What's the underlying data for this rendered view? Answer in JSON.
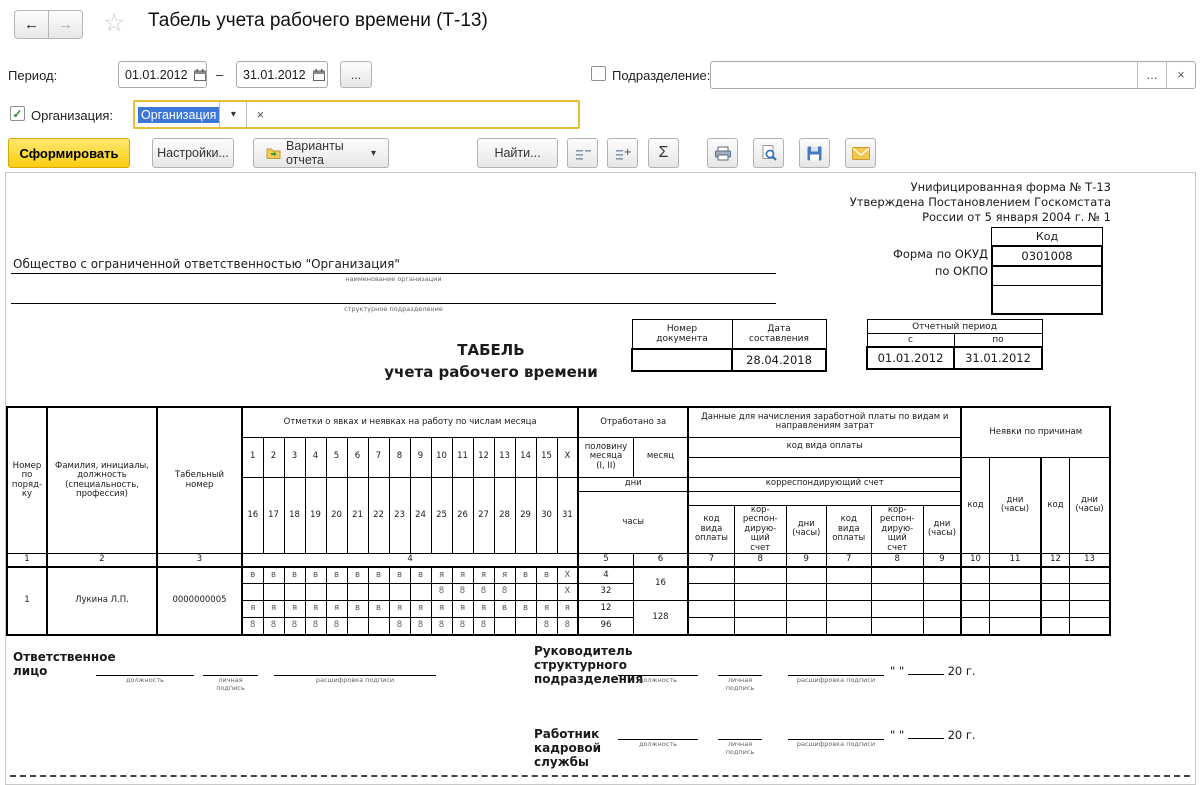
{
  "nav": {
    "back": "←",
    "forward": "→",
    "star": "☆",
    "title": "Табель учета рабочего времени (Т-13)"
  },
  "filters": {
    "period_label": "Период:",
    "period_from": "01.01.2012",
    "period_dash": "–",
    "period_to": "31.01.2012",
    "ellipsis": "...",
    "department_label": "Подразделение:",
    "department_value": "",
    "clear": "×",
    "dropdown": "▾",
    "org_label": "Организация:",
    "org_value": "Организация"
  },
  "toolbar": {
    "generate": "Сформировать",
    "settings": "Настройки...",
    "variants": "Варианты отчета",
    "find": "Найти...",
    "sum": "Σ"
  },
  "report": {
    "notes": [
      "Унифицированная форма № Т-13",
      "Утверждена Постановлением Госкомстата",
      "России от 5 января 2004 г. № 1"
    ],
    "code_header": "Код",
    "okud_label": "Форма по ОКУД",
    "okud_value": "0301008",
    "okpo_label": "по ОКПО",
    "org_name": "Общество с ограниченной ответственностью \"Организация\"",
    "org_caption": "наименование организации",
    "subdiv_caption": "структурное подразделение",
    "doc_num_header": "Номер\nдокумента",
    "doc_date_header": "Дата\nсоставления",
    "doc_num": "",
    "doc_date": "28.04.2018",
    "period_header": "Отчетный период",
    "from_label": "с",
    "to_label": "по",
    "period_from": "01.01.2012",
    "period_to": "31.01.2012",
    "title1": "ТАБЕЛЬ",
    "title2": "учета рабочего времени"
  },
  "grid": {
    "col1": "Номер\nпо\nпоряд-\nку",
    "col2": "Фамилия, инициалы,\nдолжность\n(специальность,\nпрофессия)",
    "col3": "Табельный\nномер",
    "marks_title": "Отметки о явках и неявках на работу по числам месяца",
    "worked_title": "Отработано за",
    "half_month": "половину\nмесяца\n(I, II)",
    "month": "месяц",
    "days_band": "дни",
    "hours_band": "часы",
    "pay_title": "Данные для начисления заработной платы по видам и\nнаправлениям затрат",
    "pay_code_band": "код вида оплаты",
    "corr_band": "корреспондирующий счет",
    "pay_code_col": "код\nвида\nоплаты",
    "corr_col": "кор-\nреспон-\nдирую-\nщий\nсчет",
    "dh_col": "дни\n(часы)",
    "absence_title": "Неявки по причинам",
    "code_col": "код",
    "days_top": [
      "1",
      "2",
      "3",
      "4",
      "5",
      "6",
      "7",
      "8",
      "9",
      "10",
      "11",
      "12",
      "13",
      "14",
      "15",
      "X"
    ],
    "days_bottom": [
      "16",
      "17",
      "18",
      "19",
      "20",
      "21",
      "22",
      "23",
      "24",
      "25",
      "26",
      "27",
      "28",
      "29",
      "30",
      "31"
    ],
    "col_numbers": [
      "1",
      "2",
      "3",
      "4",
      "5",
      "6",
      "7",
      "8",
      "9",
      "7",
      "8",
      "9",
      "10",
      "11",
      "12",
      "13"
    ],
    "row": {
      "num": "1",
      "name": "Лукина  Л.П.",
      "tab_number": "0000000005",
      "codes_top": [
        "в",
        "в",
        "в",
        "в",
        "в",
        "в",
        "в",
        "в",
        "в",
        "я",
        "я",
        "я",
        "я",
        "в",
        "в",
        "X"
      ],
      "hours_top": [
        "",
        "",
        "",
        "",
        "",
        "",
        "",
        "",
        "",
        "8",
        "8",
        "8",
        "8",
        "",
        "",
        "X"
      ],
      "codes_bottom": [
        "я",
        "я",
        "я",
        "я",
        "я",
        "в",
        "в",
        "я",
        "я",
        "я",
        "я",
        "я",
        "в",
        "в",
        "я",
        "я"
      ],
      "hours_bottom": [
        "8",
        "8",
        "8",
        "8",
        "8",
        "",
        "",
        "8",
        "8",
        "8",
        "8",
        "8",
        "",
        "",
        "8",
        "8"
      ],
      "days_half1": "4",
      "hours_half1": "32",
      "days_month": "16",
      "days_half2": "12",
      "hours_half2": "96",
      "hours_month": "128"
    }
  },
  "signatures": {
    "responsible": "Ответственное\nлицо",
    "head": "Руководитель\nструктурного\nподразделения",
    "hr": "Работник\nкадровой\nслужбы",
    "pos_caption": "должность",
    "sig_caption": "личная\nподпись",
    "name_caption": "расшифровка подписи",
    "quotes": "\"  \"",
    "year_prefix": "20",
    "year_suffix": "г."
  }
}
